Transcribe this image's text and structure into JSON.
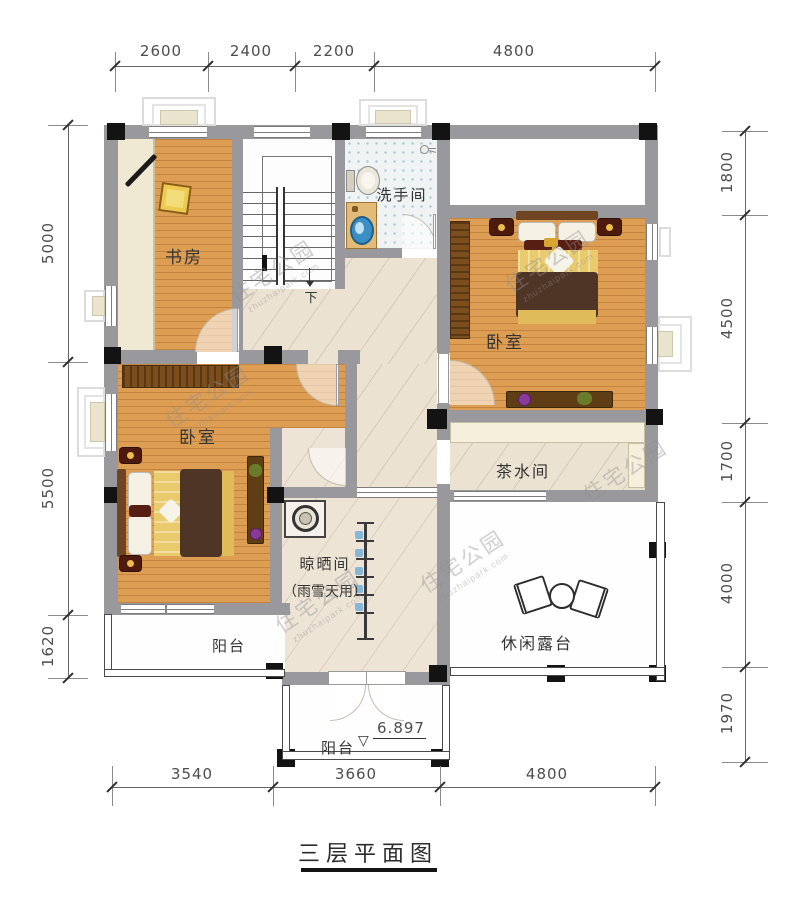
{
  "title": {
    "text": "三层平面图"
  },
  "rooms": {
    "study": "书房",
    "bathroom": "洗手间",
    "bedroom_right": "卧室",
    "bedroom_left": "卧室",
    "tea_room": "茶水间",
    "drying_room": "晾晒间",
    "drying_room_note": "（雨雪天用）",
    "leisure_terrace": "休闲露台",
    "balcony_left": "阳台",
    "balcony_front": "阳台"
  },
  "annotations": {
    "stair_down": "下",
    "elevation": "6.897"
  },
  "watermark": {
    "text": "住宅公园",
    "url": "zhuzhaipark.com"
  },
  "dimensions": {
    "top": [
      "2600",
      "2400",
      "2200",
      "4800"
    ],
    "left": [
      "5000",
      "5500",
      "1620"
    ],
    "right": [
      "1800",
      "4500",
      "1700",
      "4000",
      "1970"
    ],
    "bottom": [
      "3540",
      "3660",
      "4800"
    ]
  }
}
